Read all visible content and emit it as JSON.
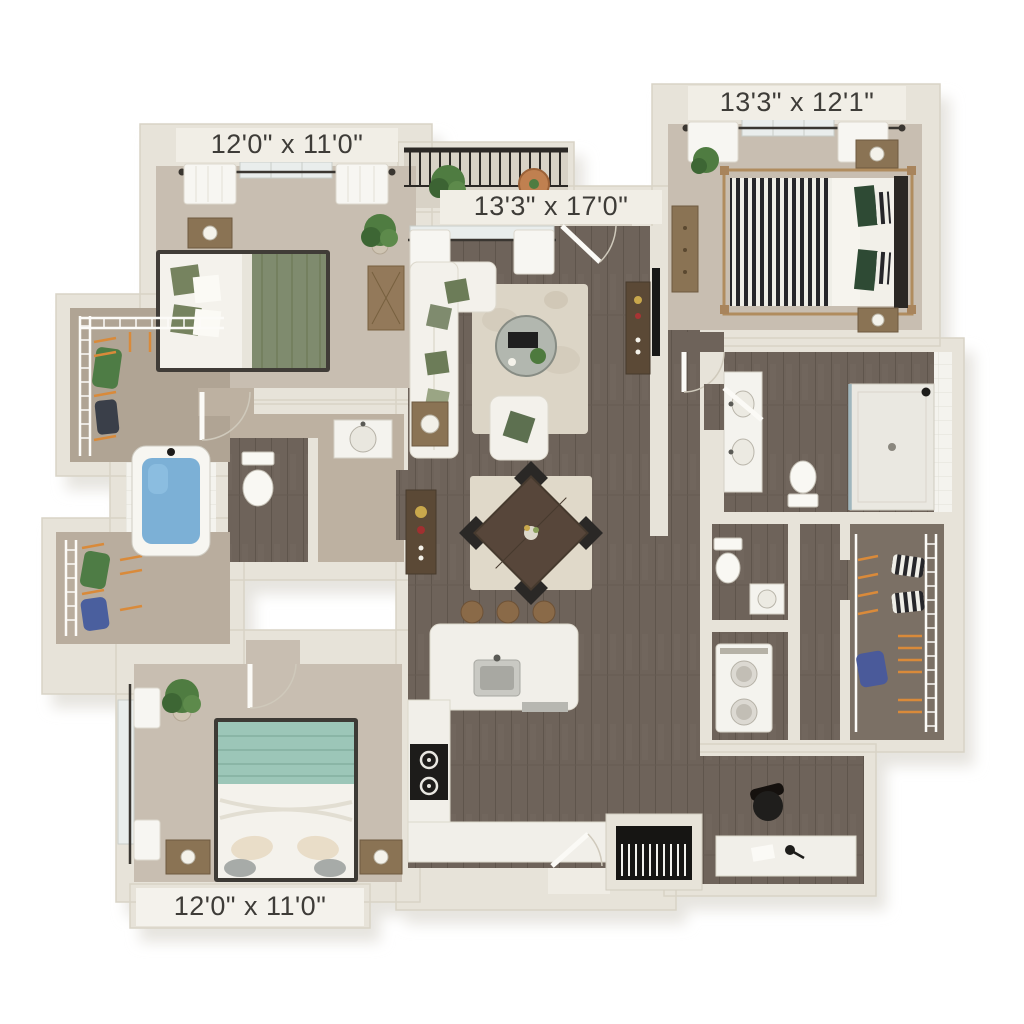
{
  "plan": {
    "labels": {
      "bedroom_top_left": "12'0\" x 11'0\"",
      "bedroom_top_right": "13'3\" x 12'1\"",
      "living_room": "13'3\" x 17'0\"",
      "bedroom_bottom_left": "12'0\" x 11'0\""
    },
    "colors": {
      "background": "#ffffff",
      "wall": "#e7e3d9",
      "wall_outline": "#d8d3c6",
      "wood_floor": "#6e635a",
      "wood_plank_line": "#5f554c",
      "carpet": "#c8beb1",
      "hall_carpet": "#bdb1a1",
      "closet_floor": "#b0a494",
      "closet_floor_dark": "#7b7065",
      "balcony_floor": "#d8d2c6",
      "rug": "#dcd5c6",
      "dining_rug": "#e0d9c9",
      "sofa_white": "#f3f1eb",
      "accent_sage": "#7f8b6e",
      "accent_dark_green": "#2e4a34",
      "accent_teal": "#9cc6b8",
      "tub_blue": "#7cb0d6",
      "wood_furniture": "#8a7354",
      "dark_wood": "#5b4936",
      "appliance_black": "#1d1c1a",
      "railing_black": "#2b2825",
      "hanger_orange": "#d98a3a",
      "plant_green": "#4f7c41",
      "label_band": "#f1eee6",
      "label_text": "#3e3c38"
    },
    "furniture": [
      "bed",
      "canopy-bed",
      "nightstand",
      "table-lamp",
      "floor-plant",
      "desk",
      "dresser",
      "sofa",
      "armchair",
      "coffee-table",
      "side-table",
      "tv",
      "media-console",
      "area-rug",
      "dining-table",
      "dining-chair",
      "buffet-console",
      "kitchen-island",
      "kitchen-sink",
      "bar-stool",
      "range-cooktop",
      "bathtub",
      "toilet",
      "shower",
      "vanity-sink",
      "stacked-washer-dryer",
      "wire-shelving",
      "hanging-clothes",
      "office-desk",
      "office-chair",
      "hvac-vent",
      "balcony-railing",
      "window",
      "door"
    ]
  }
}
